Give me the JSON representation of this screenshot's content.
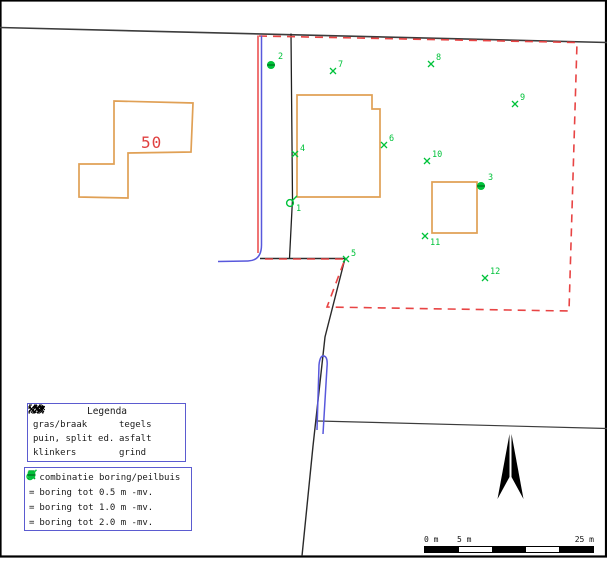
{
  "map": {
    "frame": {
      "x": 0.5,
      "y": 0.5,
      "w": 605.5,
      "h": 556
    },
    "boundary_lines": [
      {
        "name": "north-boundary-line",
        "d": "M0,27.5 L607,42.5"
      },
      {
        "name": "south-boundary-line",
        "d": "M318,421 L607,428.5"
      },
      {
        "name": "west-parcel-line",
        "d": "M345,258.5 L325,337 L313,446 L302,556"
      },
      {
        "name": "center-parcel-line",
        "d": "M291,33.5 L292.5,199 L289.5,258.5"
      },
      {
        "name": "junction-line",
        "d": "M260,258.5 L345,258.5"
      }
    ],
    "red_solid_line": {
      "d": "M258,35.5 L258,253"
    },
    "red_dashed_outline": {
      "d": "M259,36 L577,42.5 L569,311 L327,307 L345,259 L261,259"
    },
    "blue_line": {
      "d": "M261.5,35.5 L261.5,245 Q261.5,260.5 248,261 L218,261.5"
    },
    "buildings": [
      {
        "name": "building-50",
        "points": "114,101 193,103 191,152 128,153 128,198 79,197 79,164 114,164"
      },
      {
        "name": "building-central",
        "points": "297,95 372,95 372,109 380,109 380,197 297,197"
      },
      {
        "name": "building-small-east",
        "points": "432,182 477,182 477,233 432,233"
      }
    ],
    "house_number": {
      "text": "50",
      "x": 141,
      "y": 148
    },
    "markers": [
      {
        "id": "1",
        "type": "combi",
        "x": 290,
        "y": 203,
        "lx": 296,
        "ly": 211
      },
      {
        "id": "2",
        "type": "b2",
        "x": 271,
        "y": 65,
        "lx": 278,
        "ly": 59
      },
      {
        "id": "3",
        "type": "b2",
        "x": 481,
        "y": 186,
        "lx": 488,
        "ly": 180
      },
      {
        "id": "4",
        "type": "x",
        "x": 295,
        "y": 154,
        "lx": 300,
        "ly": 151
      },
      {
        "id": "5",
        "type": "x",
        "x": 346,
        "y": 259,
        "lx": 351,
        "ly": 256
      },
      {
        "id": "6",
        "type": "x",
        "x": 384,
        "y": 145,
        "lx": 389,
        "ly": 141
      },
      {
        "id": "7",
        "type": "x",
        "x": 333,
        "y": 71,
        "lx": 338,
        "ly": 67
      },
      {
        "id": "8",
        "type": "x",
        "x": 431,
        "y": 64,
        "lx": 436,
        "ly": 60
      },
      {
        "id": "9",
        "type": "x",
        "x": 515,
        "y": 104,
        "lx": 520,
        "ly": 100
      },
      {
        "id": "10",
        "type": "x",
        "x": 427,
        "y": 161,
        "lx": 432,
        "ly": 157
      },
      {
        "id": "11",
        "type": "x",
        "x": 425,
        "y": 236,
        "lx": 430,
        "ly": 245
      },
      {
        "id": "12",
        "type": "x",
        "x": 485,
        "y": 278,
        "lx": 490,
        "ly": 274
      }
    ],
    "colors": {
      "building": "#e0a055",
      "red": "#e83a3a",
      "green": "#00c23a",
      "blue": "#5858dc",
      "boundary": "#3c3c3c",
      "house_number": "#e04040"
    }
  },
  "legend_surface": {
    "title": "Legenda",
    "items": [
      {
        "icon": "gras-braak-icon",
        "label": "gras/braak"
      },
      {
        "icon": "tegels-icon",
        "label": "tegels"
      },
      {
        "icon": "puin-split-icon",
        "label": "puin, split ed."
      },
      {
        "icon": "asfalt-icon",
        "label": "asfalt"
      },
      {
        "icon": "klinkers-icon",
        "label": "klinkers"
      },
      {
        "icon": "grind-icon",
        "label": "grind"
      }
    ]
  },
  "legend_borings": {
    "equals": "=",
    "items": [
      {
        "symbol": "combi",
        "label": "combinatie boring/peilbuis"
      },
      {
        "symbol": "x05",
        "label": "boring tot 0.5 m -mv."
      },
      {
        "symbol": "x10",
        "label": "boring tot 1.0 m -mv."
      },
      {
        "symbol": "b20",
        "label": "boring tot 2.0 m -mv."
      }
    ]
  },
  "scalebar": {
    "label_0": "0 m",
    "label_5": "5 m",
    "label_25": "25 m",
    "segments": 5
  }
}
